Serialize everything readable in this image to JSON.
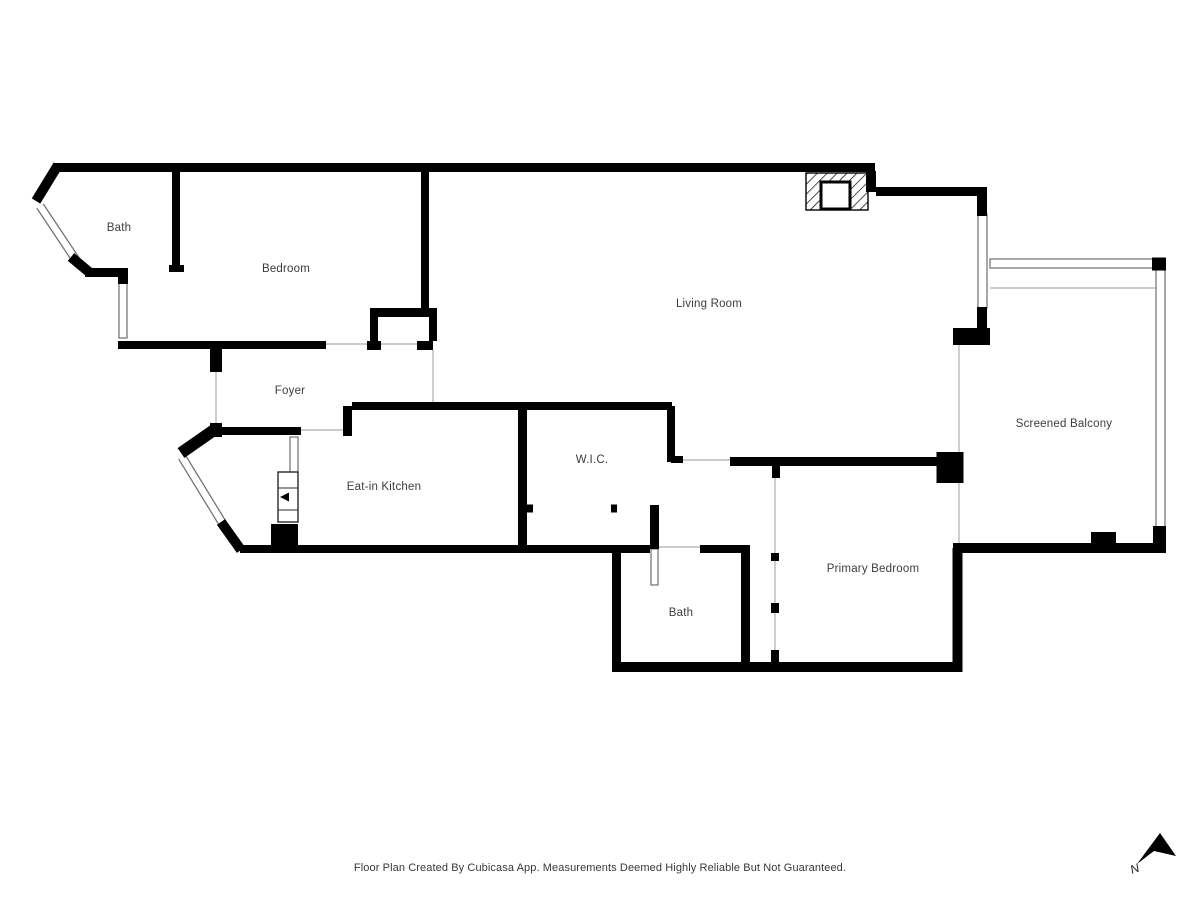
{
  "footer": {
    "text": "Floor Plan Created By Cubicasa App. Measurements Deemed Highly Reliable But Not Guaranteed."
  },
  "colors": {
    "wall": "#000000",
    "window_edge": "#6f6f6f",
    "thin_line": "#bcbcbc",
    "label": "#3c3c3c",
    "footer": "#383838"
  },
  "compass": {
    "label": "N",
    "points": "1160,833 1176,856 1154,851 1137,864",
    "label_x": 1132,
    "label_y": 874
  },
  "floorplan": {
    "rooms": [
      {
        "label": "Bath",
        "x": 119,
        "y": 231
      },
      {
        "label": "Bedroom",
        "x": 286,
        "y": 272
      },
      {
        "label": "Living Room",
        "x": 709,
        "y": 307
      },
      {
        "label": "Foyer",
        "x": 290,
        "y": 394
      },
      {
        "label": "Eat-in Kitchen",
        "x": 384,
        "y": 490
      },
      {
        "label": "W.I.C.",
        "x": 592,
        "y": 463
      },
      {
        "label": "Bath",
        "x": 681,
        "y": 616
      },
      {
        "label": "Primary Bedroom",
        "x": 873,
        "y": 572
      },
      {
        "label": "Screened Balcony",
        "x": 1064,
        "y": 427
      }
    ],
    "walls": [
      [
        55,
        167.5,
        875,
        167.5,
        9
      ],
      [
        871,
        171,
        871,
        192,
        10
      ],
      [
        876,
        191.5,
        987,
        191.5,
        9
      ],
      [
        982,
        195,
        982,
        216,
        10
      ],
      [
        982,
        307,
        982,
        331,
        10
      ],
      [
        953,
        336.5,
        990,
        336.5,
        17
      ],
      [
        1152,
        264,
        1166,
        264,
        13
      ],
      [
        1159.5,
        526,
        1159.5,
        553,
        13
      ],
      [
        953,
        548,
        1166,
        548,
        10
      ],
      [
        1091,
        537.5,
        1116,
        537.5,
        11
      ],
      [
        950,
        452,
        950,
        483,
        27
      ],
      [
        957.5,
        548,
        957.5,
        672,
        10
      ],
      [
        612,
        667,
        962,
        667,
        10
      ],
      [
        616.5,
        549,
        616.5,
        662,
        9
      ],
      [
        612,
        549,
        650,
        549,
        8
      ],
      [
        654.5,
        505,
        654.5,
        549,
        9
      ],
      [
        700,
        549,
        750,
        549,
        8
      ],
      [
        745.5,
        553,
        745.5,
        662,
        9
      ],
      [
        775,
        553,
        775,
        561,
        8
      ],
      [
        775,
        603,
        775,
        613,
        8
      ],
      [
        775,
        650,
        775,
        662,
        8
      ],
      [
        776,
        461,
        776,
        478,
        8
      ],
      [
        730,
        461.5,
        962,
        461.5,
        9
      ],
      [
        671,
        406,
        671,
        462,
        8
      ],
      [
        671,
        459.5,
        683,
        459.5,
        7
      ],
      [
        352,
        406,
        672,
        406,
        8
      ],
      [
        347.5,
        406,
        347.5,
        436,
        9
      ],
      [
        217,
        431,
        301,
        431,
        8
      ],
      [
        522.5,
        406,
        522.5,
        553,
        9
      ],
      [
        527,
        508.5,
        533,
        508.5,
        8
      ],
      [
        611,
        508.5,
        617,
        508.5,
        8
      ],
      [
        240,
        549,
        613,
        549,
        8
      ],
      [
        284.5,
        524,
        284.5,
        547,
        27
      ],
      [
        425,
        172,
        425,
        317,
        8
      ],
      [
        370,
        312.5,
        437,
        312.5,
        9
      ],
      [
        374,
        313,
        374,
        341,
        8
      ],
      [
        367,
        345.5,
        381,
        345.5,
        9
      ],
      [
        417,
        345.5,
        433,
        345.5,
        9
      ],
      [
        433,
        313,
        433,
        341,
        8
      ],
      [
        118,
        345,
        326,
        345,
        8
      ],
      [
        123,
        277,
        123,
        284,
        10
      ],
      [
        85,
        272.5,
        128,
        272.5,
        9
      ],
      [
        176,
        172,
        176,
        265,
        8
      ],
      [
        169,
        268.5,
        184,
        268.5,
        7
      ],
      [
        216,
        345,
        216,
        372,
        12
      ],
      [
        216,
        423,
        216,
        437,
        12
      ],
      [
        214,
        430,
        181,
        453,
        12
      ],
      [
        221,
        522,
        241,
        550,
        10
      ],
      [
        58,
        165,
        36,
        201,
        10
      ],
      [
        71,
        257,
        89,
        272,
        10
      ]
    ],
    "windows": [
      [
        119,
        283,
        8,
        55
      ],
      [
        978,
        214,
        9,
        94
      ],
      [
        290,
        437,
        8,
        36
      ],
      [
        990,
        259,
        163,
        9
      ],
      [
        1156,
        268,
        9,
        259
      ]
    ],
    "door_leaf": [
      651,
      549,
      7,
      36
    ],
    "window_diagonals": [
      [
        40,
        206,
        76,
        260,
        9
      ],
      [
        182,
        457,
        223,
        524,
        9
      ]
    ],
    "thin_lines": [
      [
        959,
        345,
        959,
        452
      ],
      [
        959,
        483,
        959,
        543
      ],
      [
        990,
        288,
        1156,
        288
      ],
      [
        433,
        350,
        433,
        402
      ],
      [
        326,
        344,
        367,
        344
      ],
      [
        381,
        344,
        417,
        344
      ],
      [
        683,
        460,
        730,
        460
      ],
      [
        650,
        547,
        700,
        547
      ],
      [
        301,
        430,
        343,
        430
      ],
      [
        216,
        372,
        216,
        423
      ],
      [
        775,
        478,
        775,
        553
      ],
      [
        775,
        561,
        775,
        603
      ],
      [
        775,
        613,
        775,
        650
      ]
    ],
    "fireplace": {
      "x": 806,
      "y": 173,
      "w": 62,
      "h": 37,
      "inner": {
        "x": 821,
        "y": 182,
        "w": 29,
        "h": 27
      }
    },
    "appliance": {
      "x": 278,
      "y": 472,
      "w": 20,
      "h": 50,
      "lines": [
        488,
        510
      ],
      "arrow": {
        "x": 280,
        "y": 497
      }
    }
  }
}
